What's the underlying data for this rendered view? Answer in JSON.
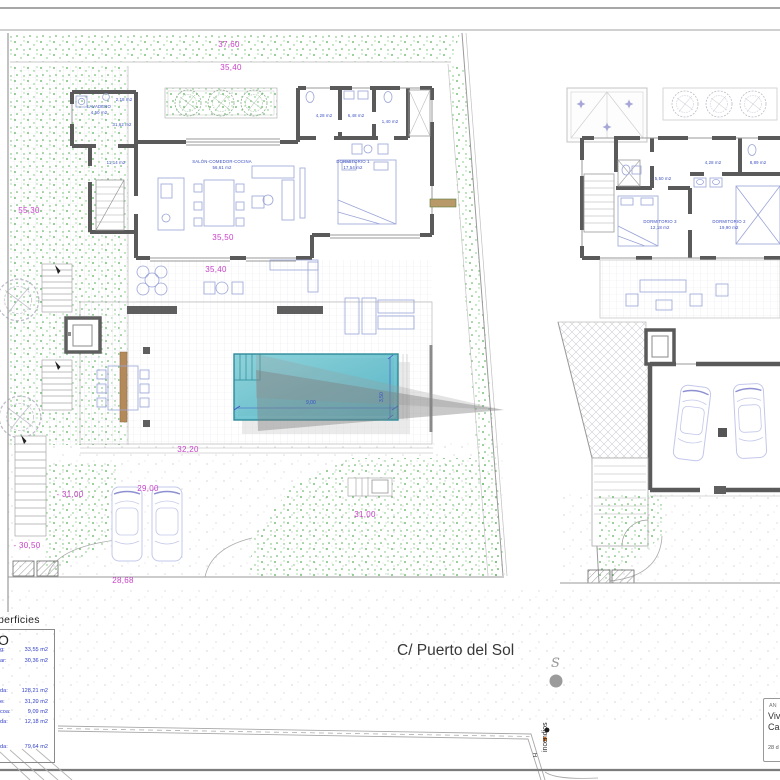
{
  "street": {
    "name": "C/ Puerto del Sol"
  },
  "dims": {
    "site_width": "37,60",
    "house_top": "35,40",
    "site_left": "55,30",
    "house_bottom": "35,50",
    "terrace": "35,40",
    "deck": "32,20",
    "level_a": "- 31,00",
    "driveway": "29,00",
    "garden_level": "31,00",
    "level_b": "- 30,50",
    "frontage": "28,68"
  },
  "pool": {
    "length": "9,00",
    "width": "3,50"
  },
  "ground_floor": {
    "lavadero": {
      "name": "LAVADERO",
      "area": "4,50 m2"
    },
    "aseo": {
      "area": "2,18 m2"
    },
    "hall_upper": {
      "area": "31,62 m2"
    },
    "hall": {
      "area": "11,14 m2"
    },
    "salon": {
      "name": "SALÓN-COMEDOR-COCINA",
      "area": "56,61 m2"
    },
    "dormitorio1": {
      "name": "DORMITORIO 1",
      "area": "17,54 m2"
    },
    "bano_a": {
      "area": "4,28 m2"
    },
    "bano_b": {
      "area": "6,48 m2"
    },
    "bano_c": {
      "area": "1,40 m2"
    }
  },
  "upper_floor": {
    "bano_d": {
      "area": "5,50 m2"
    },
    "bano_e": {
      "area": "4,28 m2"
    },
    "bano_f": {
      "area": "8,89 m2"
    },
    "dormitorio3": {
      "name": "DORMITORIO 3",
      "area": "12,18 m2"
    },
    "dormitorio2": {
      "name": "DORMITORIO  2",
      "area": "19,90 m2"
    }
  },
  "surfaces_panel": {
    "header_fragment": "perficies",
    "subheader_fragment": "O",
    "rows": [
      {
        "label": "g:",
        "value": "33,55 m2"
      },
      {
        "label": "ar:",
        "value": "30,36 m2"
      },
      {
        "label": "da:",
        "value": "128,21 m2"
      },
      {
        "label": "e:",
        "value": "31,20 m2"
      },
      {
        "label": "coa:",
        "value": "9,09 m2"
      },
      {
        "label": "da:",
        "value": "12,18 m2"
      },
      {
        "label": "da:",
        "value": "79,64 m2"
      }
    ]
  },
  "street_symbols": {
    "sewer_letter": "S",
    "hydrant_label": "incendios",
    "hydrant_letter": "H"
  },
  "title_block": {
    "line1": "AN",
    "line2": "Viv",
    "line3": "Ca",
    "line4": "28 d"
  },
  "colors": {
    "dimension_magenta": "#c83fc8",
    "room_label_blue": "#3a4ec0",
    "pool_teal": "#62bcca",
    "vegetation_green": "#55b055",
    "wall_gray": "#5a5a5a",
    "hydrant_orange": "#cc6a1e",
    "shadow_gray": "#8a8a8a"
  }
}
